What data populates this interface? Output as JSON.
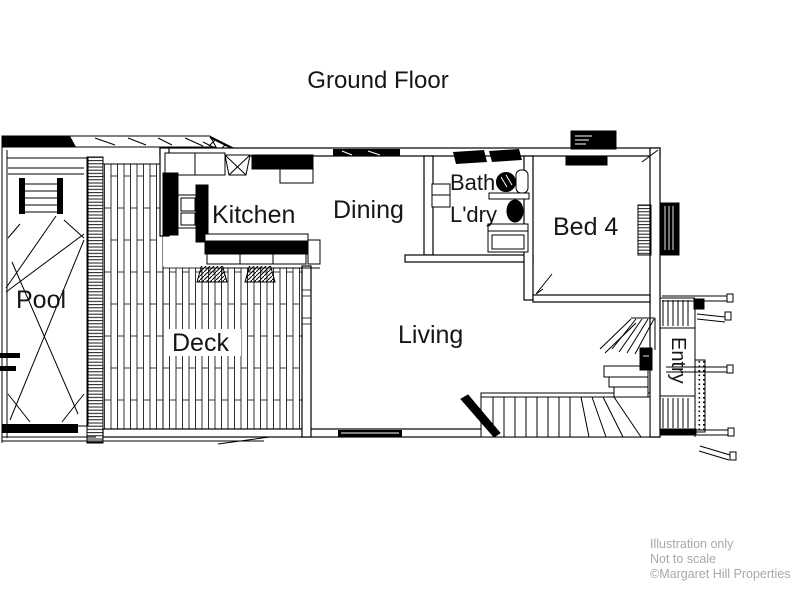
{
  "title": "Ground Floor",
  "rooms": {
    "pool": {
      "label": "Pool"
    },
    "deck": {
      "label": "Deck"
    },
    "kitchen": {
      "label": "Kitchen"
    },
    "dining": {
      "label": "Dining"
    },
    "bath": {
      "label": "Bath"
    },
    "ldry": {
      "label": "L'dry"
    },
    "bed4": {
      "label": "Bed 4"
    },
    "living": {
      "label": "Living"
    },
    "entry": {
      "label": "Entry"
    }
  },
  "footer": {
    "line1": "Illustration only",
    "line2": "Not to scale",
    "line3": "©Margaret Hill Properties"
  },
  "colors": {
    "line": "#000000",
    "background": "#ffffff",
    "label": "#161616",
    "footer": "#a8a8a8"
  }
}
